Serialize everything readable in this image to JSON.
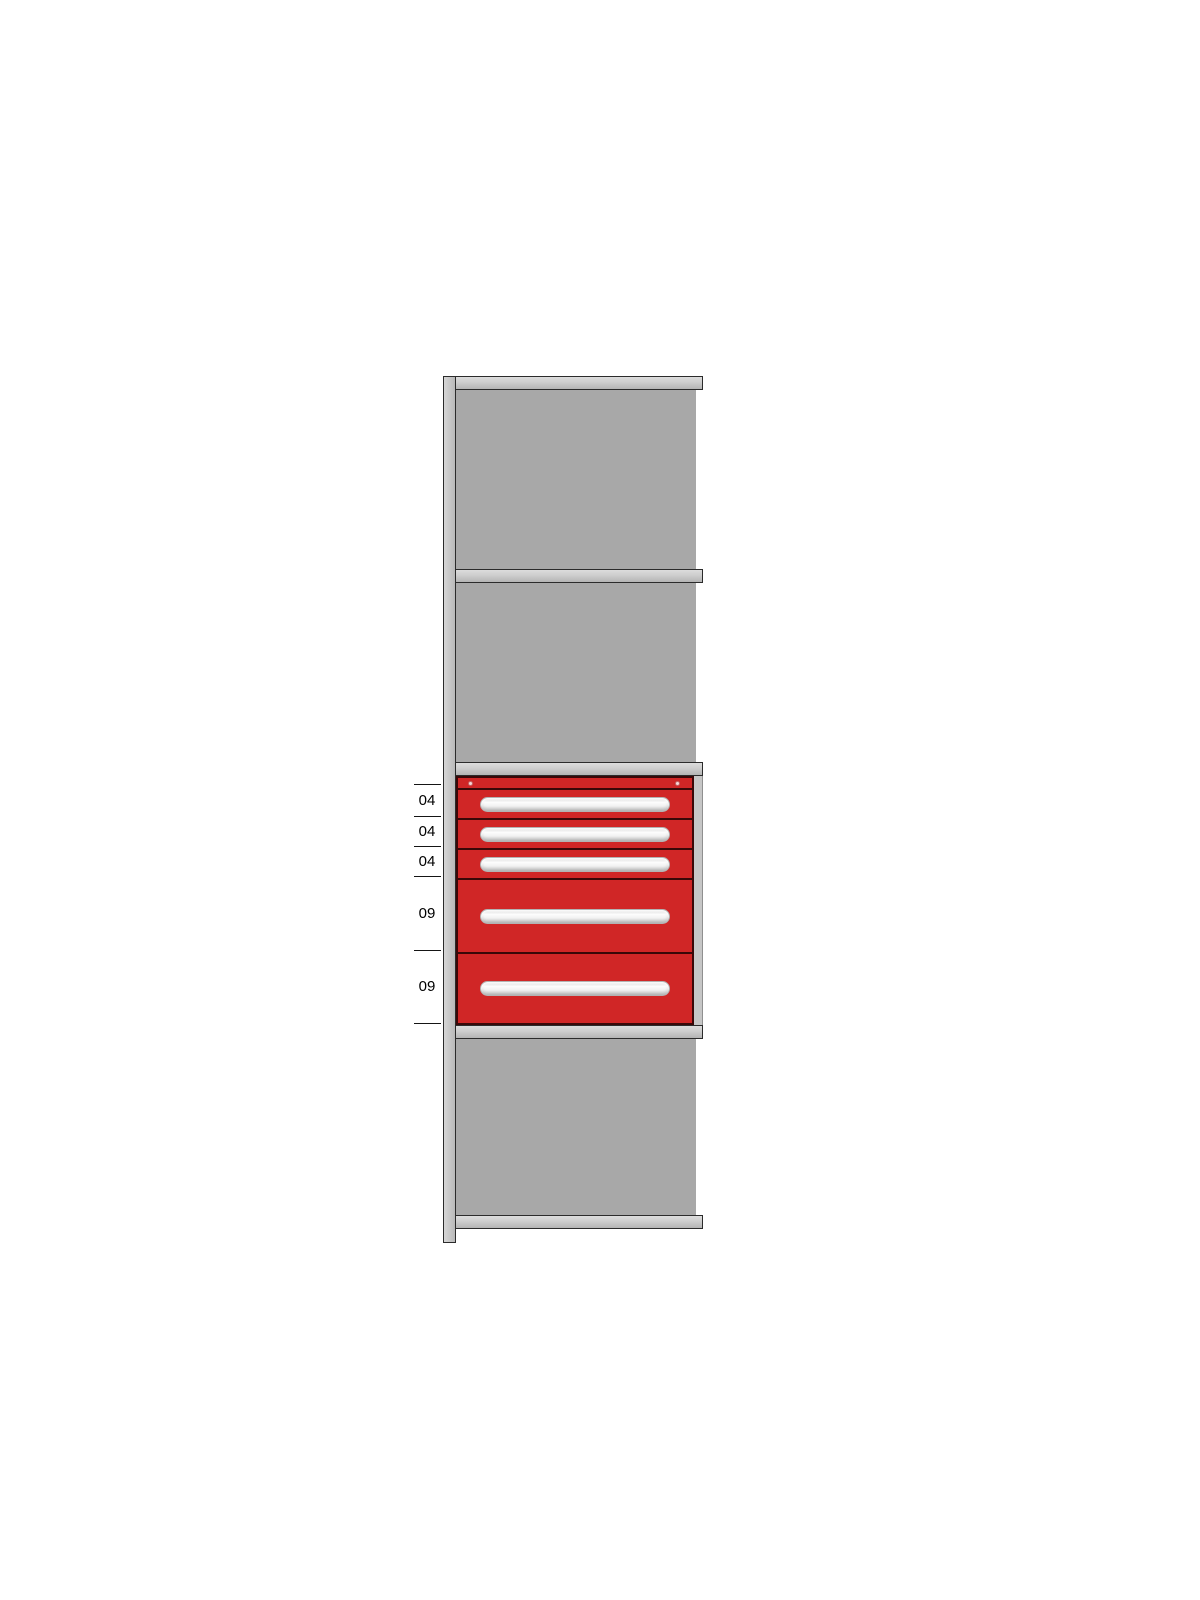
{
  "diagram": {
    "kind": "shelving-bay-elevation-with-drawer-cabinet",
    "size_labels": [
      "04",
      "04",
      "04",
      "09",
      "09"
    ],
    "drawers": [
      {
        "label": "04"
      },
      {
        "label": "04"
      },
      {
        "label": "04"
      },
      {
        "label": "09"
      },
      {
        "label": "09"
      }
    ],
    "colors": {
      "drawer_red": "#d02626",
      "drawer_outline": "#3a0808",
      "panel_gray": "#a8a8a8",
      "frame_outline": "#2b2b2b"
    }
  }
}
